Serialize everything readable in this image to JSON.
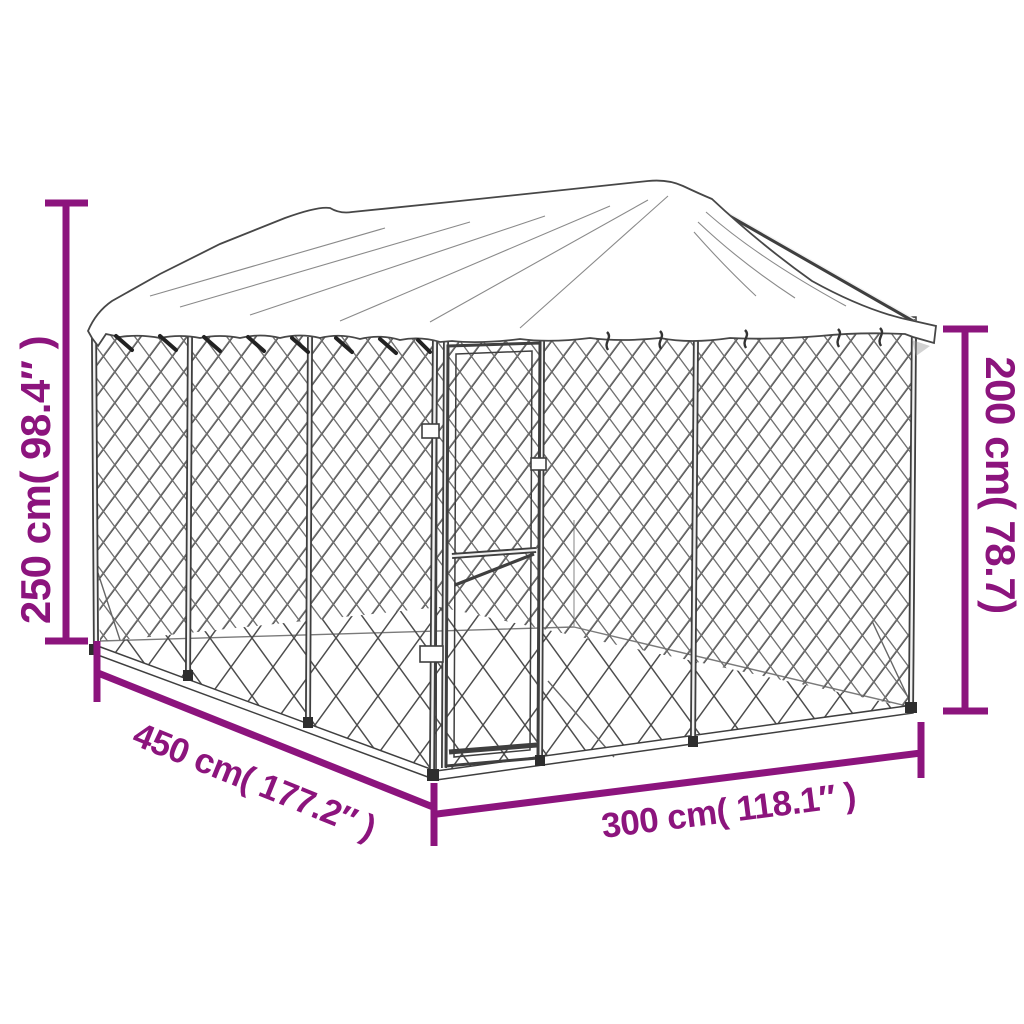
{
  "product": {
    "name": "outdoor dog kennel with roof"
  },
  "colors": {
    "accent": "#8C147D",
    "line": "#3f3f3f",
    "mesh": "#4f4f4f",
    "background": "#ffffff"
  },
  "dimensions": {
    "height_total": {
      "text": "250 cm( 98.4″ )",
      "side": "left",
      "orientation": "vertical"
    },
    "height_wall": {
      "text": "200 cm( 78.7)",
      "side": "right",
      "orientation": "vertical"
    },
    "depth": {
      "text": "450 cm( 177.2″ )",
      "side": "bottom-left",
      "orientation": "diagonal"
    },
    "width": {
      "text": "300 cm( 118.1″ )",
      "side": "bottom",
      "orientation": "diagonal"
    }
  }
}
